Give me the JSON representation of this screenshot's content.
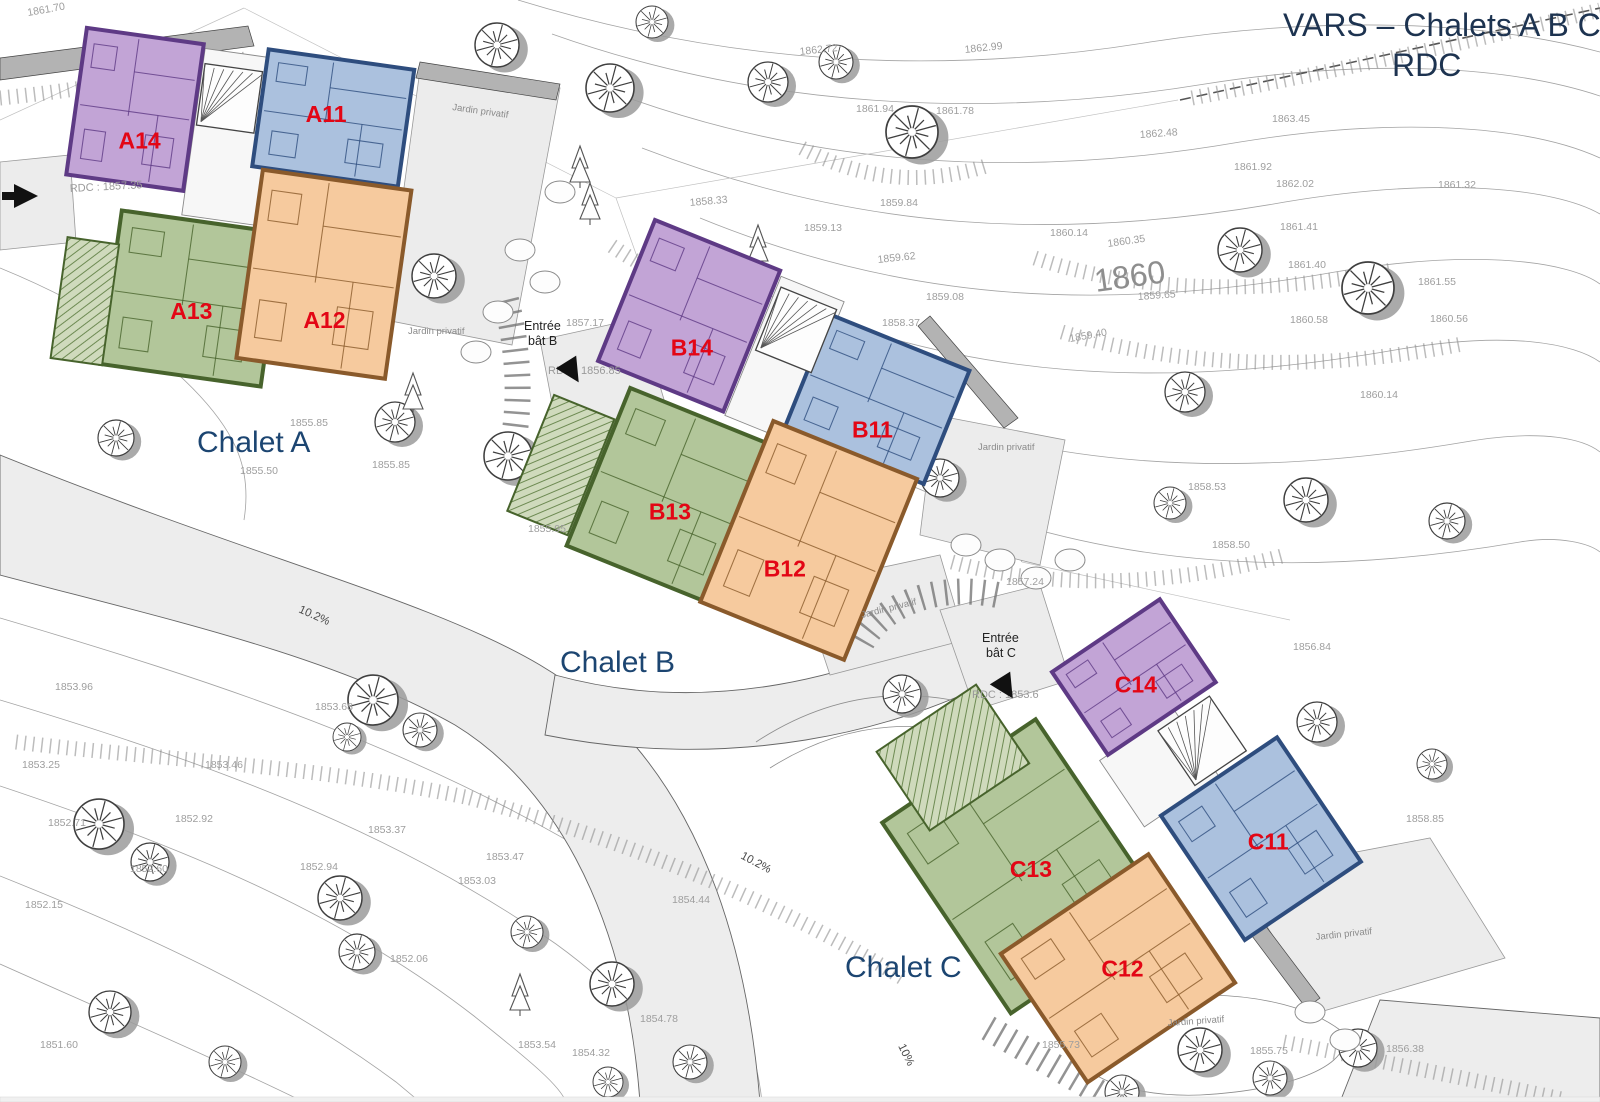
{
  "title": {
    "line1": "VARS – Chalets A B C",
    "line2": "RDC"
  },
  "colors": {
    "purple": "#c2a4d6",
    "purple_dark": "#5e3a85",
    "blue": "#abc1de",
    "blue_dark": "#2e4d7e",
    "green": "#b2c69a",
    "green_dark": "#47632c",
    "orange": "#f6ca9e",
    "orange_dark": "#8a5a2b",
    "unit_label": "#e30615",
    "chalet_label": "#1c4571",
    "title_color": "#1d3350",
    "contour_label": "#9e9e9e",
    "road_fill": "#ededed"
  },
  "chalets": [
    {
      "label": "Chalet A",
      "units": [
        {
          "id": "A14"
        },
        {
          "id": "A11"
        },
        {
          "id": "A13"
        },
        {
          "id": "A12"
        }
      ]
    },
    {
      "label": "Chalet B",
      "units": [
        {
          "id": "B14"
        },
        {
          "id": "B11"
        },
        {
          "id": "B13"
        },
        {
          "id": "B12"
        }
      ]
    },
    {
      "label": "Chalet C",
      "units": [
        {
          "id": "C14"
        },
        {
          "id": "C11"
        },
        {
          "id": "C13"
        },
        {
          "id": "C12"
        }
      ]
    }
  ],
  "entrances": {
    "b": {
      "line1": "Entrée",
      "line2": "bât B"
    },
    "c": {
      "line1": "Entrée",
      "line2": "bât C"
    }
  },
  "rdc_labels": [
    {
      "t": "RDC : 1857.35",
      "x": 70,
      "y": 192,
      "r": -3
    },
    {
      "t": "RDC : 1856.85",
      "x": 548,
      "y": 374,
      "r": 0
    },
    {
      "t": "RDC : 1853.6",
      "x": 972,
      "y": 698,
      "r": 0
    }
  ],
  "garden_label": "Jardin privatif",
  "garden_positions": [
    {
      "x": 452,
      "y": 110,
      "r": 8
    },
    {
      "x": 408,
      "y": 334,
      "r": 0
    },
    {
      "x": 978,
      "y": 450,
      "r": 0
    },
    {
      "x": 862,
      "y": 618,
      "r": -14
    },
    {
      "x": 1316,
      "y": 940,
      "r": -6
    },
    {
      "x": 1168,
      "y": 1026,
      "r": -4
    }
  ],
  "slope_labels": [
    {
      "t": "10.2%",
      "x": 298,
      "y": 612,
      "r": 24
    },
    {
      "t": "10.2%",
      "x": 740,
      "y": 858,
      "r": 28
    },
    {
      "t": "10%",
      "x": 898,
      "y": 1046,
      "r": 64
    }
  ],
  "big_contour": {
    "t": "1860",
    "x": 1096,
    "y": 292,
    "r": -8
  },
  "contour_labels": [
    {
      "t": "1861.70",
      "x": 28,
      "y": 16,
      "r": -10
    },
    {
      "t": "1862.72",
      "x": 800,
      "y": 55,
      "r": -6
    },
    {
      "t": "1862.99",
      "x": 965,
      "y": 53,
      "r": -6
    },
    {
      "t": "1861.94",
      "x": 856,
      "y": 112,
      "r": 0
    },
    {
      "t": "1861.78",
      "x": 936,
      "y": 114,
      "r": 0
    },
    {
      "t": "1862.48",
      "x": 1140,
      "y": 138,
      "r": -4
    },
    {
      "t": "1863.45",
      "x": 1272,
      "y": 122,
      "r": 0
    },
    {
      "t": "1861.92",
      "x": 1234,
      "y": 170,
      "r": 0
    },
    {
      "t": "1862.02",
      "x": 1276,
      "y": 187,
      "r": 0
    },
    {
      "t": "1861.32",
      "x": 1438,
      "y": 188,
      "r": 0
    },
    {
      "t": "1861.41",
      "x": 1280,
      "y": 230,
      "r": 0
    },
    {
      "t": "1861.40",
      "x": 1288,
      "y": 268,
      "r": 0
    },
    {
      "t": "1861.55",
      "x": 1418,
      "y": 285,
      "r": 0
    },
    {
      "t": "1860.14",
      "x": 1050,
      "y": 236,
      "r": 0
    },
    {
      "t": "1860.35",
      "x": 1108,
      "y": 247,
      "r": -8
    },
    {
      "t": "1859.65",
      "x": 1138,
      "y": 300,
      "r": -4
    },
    {
      "t": "1860.58",
      "x": 1290,
      "y": 323,
      "r": 0
    },
    {
      "t": "1859.40",
      "x": 1070,
      "y": 342,
      "r": -10
    },
    {
      "t": "1860.56",
      "x": 1430,
      "y": 322,
      "r": 0
    },
    {
      "t": "1860.14",
      "x": 1360,
      "y": 398,
      "r": 0
    },
    {
      "t": "1858.33",
      "x": 690,
      "y": 206,
      "r": -5
    },
    {
      "t": "1859.84",
      "x": 880,
      "y": 206,
      "r": 0
    },
    {
      "t": "1859.13",
      "x": 804,
      "y": 231,
      "r": 0
    },
    {
      "t": "1859.62",
      "x": 878,
      "y": 263,
      "r": -6
    },
    {
      "t": "1859.08",
      "x": 926,
      "y": 300,
      "r": 0
    },
    {
      "t": "1858.37",
      "x": 882,
      "y": 326,
      "r": 0
    },
    {
      "t": "1857.17",
      "x": 566,
      "y": 326,
      "r": 0
    },
    {
      "t": "1858.53",
      "x": 1188,
      "y": 490,
      "r": 0
    },
    {
      "t": "1858.50",
      "x": 1212,
      "y": 548,
      "r": 0
    },
    {
      "t": "1857.24",
      "x": 1006,
      "y": 585,
      "r": 0
    },
    {
      "t": "1856.84",
      "x": 1293,
      "y": 650,
      "r": 0
    },
    {
      "t": "1858.85",
      "x": 1406,
      "y": 822,
      "r": 0
    },
    {
      "t": "1855.85",
      "x": 290,
      "y": 426,
      "r": 0
    },
    {
      "t": "1855.50",
      "x": 240,
      "y": 474,
      "r": 0
    },
    {
      "t": "1855.85",
      "x": 372,
      "y": 468,
      "r": 0
    },
    {
      "t": "1855.95",
      "x": 528,
      "y": 532,
      "r": 0
    },
    {
      "t": "1853.96",
      "x": 55,
      "y": 690,
      "r": 0
    },
    {
      "t": "1853.68",
      "x": 315,
      "y": 710,
      "r": 0
    },
    {
      "t": "1853.25",
      "x": 22,
      "y": 768,
      "r": 0
    },
    {
      "t": "1853.46",
      "x": 205,
      "y": 768,
      "r": 0
    },
    {
      "t": "1852.71",
      "x": 48,
      "y": 826,
      "r": 0
    },
    {
      "t": "1852.92",
      "x": 175,
      "y": 822,
      "r": 0
    },
    {
      "t": "1852.60",
      "x": 130,
      "y": 872,
      "r": 0
    },
    {
      "t": "1853.37",
      "x": 368,
      "y": 833,
      "r": 0
    },
    {
      "t": "1852.94",
      "x": 300,
      "y": 870,
      "r": 0
    },
    {
      "t": "1853.47",
      "x": 486,
      "y": 860,
      "r": 0
    },
    {
      "t": "1853.03",
      "x": 458,
      "y": 884,
      "r": 0
    },
    {
      "t": "1852.15",
      "x": 25,
      "y": 908,
      "r": 0
    },
    {
      "t": "1852.06",
      "x": 390,
      "y": 962,
      "r": 0
    },
    {
      "t": "1851.60",
      "x": 40,
      "y": 1048,
      "r": 0
    },
    {
      "t": "1853.54",
      "x": 518,
      "y": 1048,
      "r": 0
    },
    {
      "t": "1854.32",
      "x": 572,
      "y": 1056,
      "r": 0
    },
    {
      "t": "1854.44",
      "x": 672,
      "y": 903,
      "r": 0
    },
    {
      "t": "1854.78",
      "x": 640,
      "y": 1022,
      "r": 0
    },
    {
      "t": "1855.73",
      "x": 1042,
      "y": 1048,
      "r": 0
    },
    {
      "t": "1856.38",
      "x": 1386,
      "y": 1052,
      "r": 0
    },
    {
      "t": "1855.75",
      "x": 1250,
      "y": 1054,
      "r": 0
    }
  ]
}
